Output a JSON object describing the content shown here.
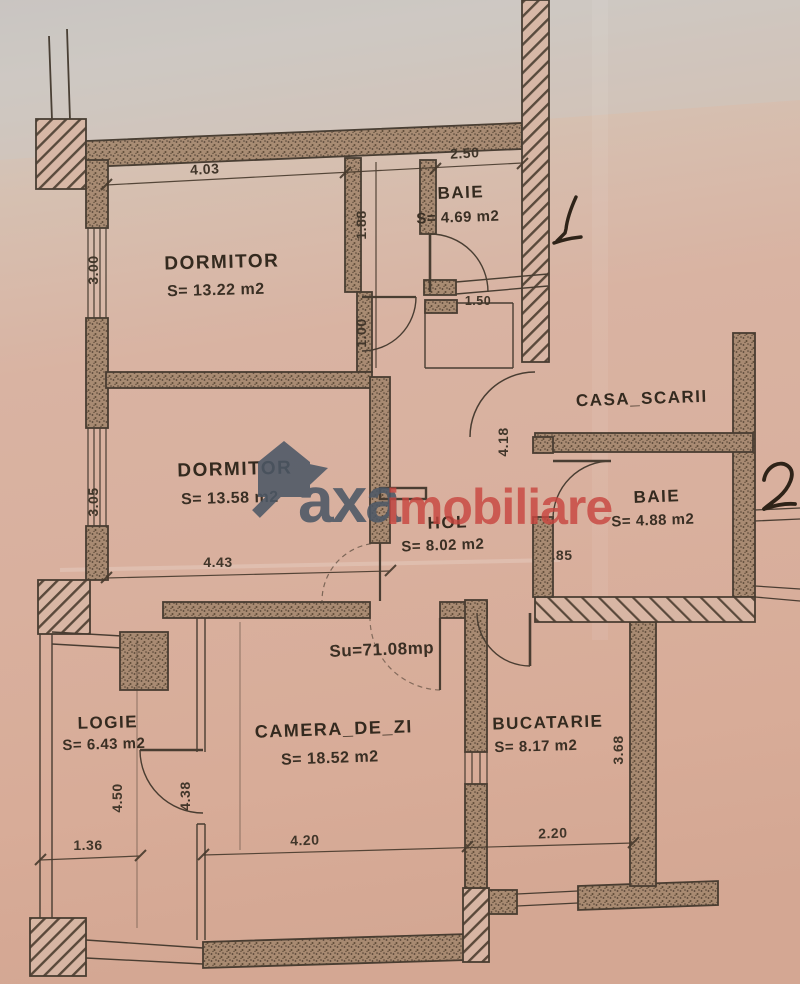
{
  "document": {
    "kind": "apartment-floor-plan-scan"
  },
  "summary": {
    "usable_area": "Su=71.08mp"
  },
  "marks": {
    "apartment1": "1",
    "apartment2": "2"
  },
  "watermark": {
    "part1": "axa",
    "part2": "imobiliare",
    "color1": "#4d5866",
    "color2": "#c8463f",
    "icon": "house-arrow-logo"
  },
  "rooms": [
    {
      "name": "DORMITOR",
      "area": "S= 13.22 m2"
    },
    {
      "name": "BAIE",
      "area": "S= 4.69 m2"
    },
    {
      "name": "DORMITOR",
      "area": "S= 13.58 m2"
    },
    {
      "name": "CASA_SCARII",
      "area": ""
    },
    {
      "name": "BAIE",
      "area": "S= 4.88 m2"
    },
    {
      "name": "HOL",
      "area": "S= 8.02 m2"
    },
    {
      "name": "LOGIE",
      "area": "S= 6.43 m2"
    },
    {
      "name": "CAMERA_DE_ZI",
      "area": "S= 18.52 m2"
    },
    {
      "name": "BUCATARIE",
      "area": "S= 8.17 m2"
    }
  ],
  "dimensions": [
    {
      "value": "4.03"
    },
    {
      "value": "2.50"
    },
    {
      "value": "1.88"
    },
    {
      "value": "1.00"
    },
    {
      "value": "3.00"
    },
    {
      "value": "3.05"
    },
    {
      "value": "4.43"
    },
    {
      "value": "1.50"
    },
    {
      "value": "4.18"
    },
    {
      "value": ".85"
    },
    {
      "value": "4.50"
    },
    {
      "value": "4.38"
    },
    {
      "value": "1.36"
    },
    {
      "value": "4.20"
    },
    {
      "value": "2.20"
    },
    {
      "value": "3.68"
    }
  ]
}
